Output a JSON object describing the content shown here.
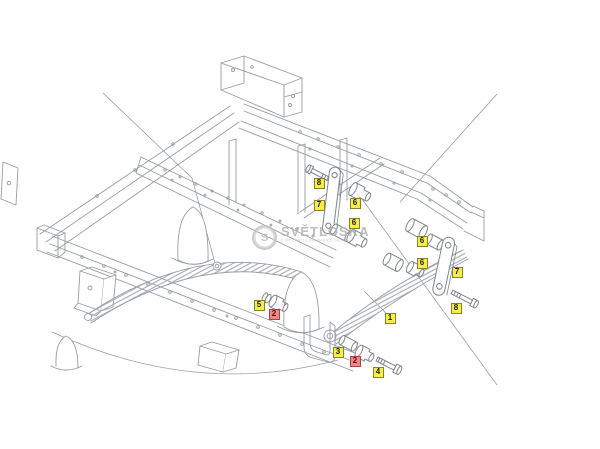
{
  "diagram": {
    "type": "exploded-parts-drawing",
    "subject": "truck chassis rear leaf-spring suspension",
    "watermark": {
      "logo_icon": "circle-badge-logo",
      "brand": "SVĚTLOSKA",
      "tagline": "SVĚT ČÁSTI K NÁHRADNÍM DÍLŮM"
    },
    "colors": {
      "background": "#ffffff",
      "line": "#979da4",
      "hardware_line": "#7f858c",
      "label_yellow_bg": "#f8ee43",
      "label_yellow_border": "#84842e",
      "label_red_bg": "#ee8787",
      "label_red_border": "#ab4343",
      "watermark_gray": "#b1b1b1"
    },
    "callouts": [
      {
        "label": "8",
        "style": "yellow",
        "x": 319,
        "y": 183,
        "name": "callout-8-bolt-upper"
      },
      {
        "label": "7",
        "style": "yellow",
        "x": 319,
        "y": 205,
        "name": "callout-7-shackle-upper"
      },
      {
        "label": "6",
        "style": "yellow",
        "x": 355,
        "y": 203,
        "name": "callout-6-bushing-a"
      },
      {
        "label": "6",
        "style": "yellow",
        "x": 354,
        "y": 223,
        "name": "callout-6-bushing-b"
      },
      {
        "label": "6",
        "style": "yellow",
        "x": 422,
        "y": 241,
        "name": "callout-6-bushing-c"
      },
      {
        "label": "6",
        "style": "yellow",
        "x": 422,
        "y": 263,
        "name": "callout-6-bushing-d"
      },
      {
        "label": "7",
        "style": "yellow",
        "x": 457,
        "y": 272,
        "name": "callout-7-shackle-lower"
      },
      {
        "label": "8",
        "style": "yellow",
        "x": 456,
        "y": 308,
        "name": "callout-8-bolt-lower"
      },
      {
        "label": "5",
        "style": "yellow",
        "x": 259,
        "y": 305,
        "name": "callout-5-ring"
      },
      {
        "label": "2",
        "style": "red",
        "x": 274,
        "y": 314,
        "name": "callout-2-bushing-left"
      },
      {
        "label": "1",
        "style": "yellow",
        "x": 390,
        "y": 318,
        "name": "callout-1-leaf-spring"
      },
      {
        "label": "3",
        "style": "yellow",
        "x": 338,
        "y": 352,
        "name": "callout-3-sleeve"
      },
      {
        "label": "2",
        "style": "red",
        "x": 355,
        "y": 361,
        "name": "callout-2-bushing-right"
      },
      {
        "label": "4",
        "style": "yellow",
        "x": 378,
        "y": 372,
        "name": "callout-4-bolt"
      }
    ]
  }
}
